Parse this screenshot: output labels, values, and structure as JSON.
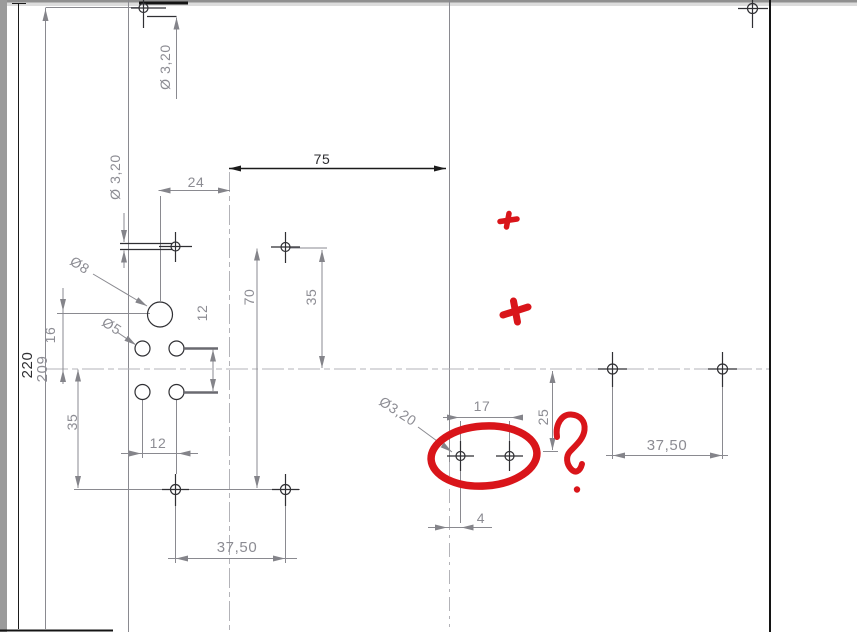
{
  "app": {
    "type": "cad-drawing-viewport",
    "description": "2D engineering drawing of a plate with holes and slots, red hand-drawn review markup"
  },
  "colors": {
    "background": "#ffffff",
    "dimension_gray": "#8c8c93",
    "geometry_dark": "#2f2f33",
    "edge_black": "#141414",
    "annotation_red": "#d9151a",
    "border_gray": "#9b9b9b"
  },
  "dims": {
    "dia_3_20_top": "Ø 3,20",
    "dia_3_20_left": "Ø 3,20",
    "dia_3_20_bottom": "Ø3,20",
    "dia_8": "Ø8",
    "dia_5": "Ø5",
    "d75": "75",
    "d24": "24",
    "d70": "70",
    "d35_right": "35",
    "d35_left": "35",
    "d16": "16",
    "d220": "220",
    "d209": "209",
    "d12_vertical": "12",
    "d12_bottom": "12",
    "d37_50_bottom": "37,50",
    "d37_50_right": "37,50",
    "d17": "17",
    "d25": "25",
    "d4": "4"
  },
  "annotations": {
    "red_marks": [
      "cross-small",
      "cross-large",
      "ellipse-highlight",
      "question-mark",
      "dot"
    ]
  }
}
